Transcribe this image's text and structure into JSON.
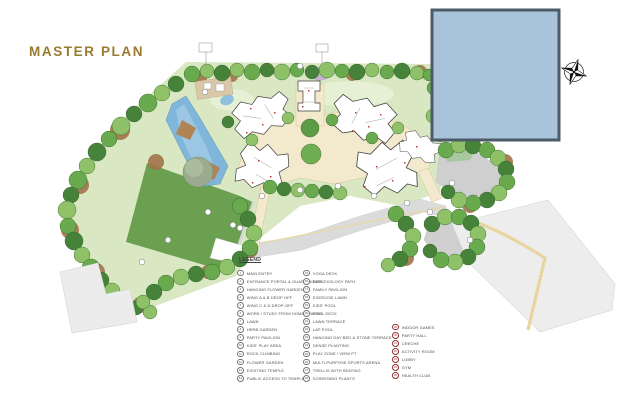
{
  "page": {
    "title": "MASTER PLAN",
    "title_color": "#9a7a2e",
    "background": "#ffffff"
  },
  "map": {
    "inset_box_color": "#a9c3da",
    "inset_box_border": "#4b5c68",
    "compass_icon": "compass-rose",
    "colors": {
      "base_green": "#d9e8c2",
      "lawn_dark": "#6aa04f",
      "tree_dark": "#47823a",
      "tree_mid": "#6aaa4e",
      "tree_light": "#8fc268",
      "mulch_brown": "#a2734b",
      "pool_blue": "#7fb6d9",
      "pool_light": "#a8cfe8",
      "deck_brown": "#b08455",
      "path_cream": "#f3e9cc",
      "road_gray": "#dbdbdb",
      "parcel_gray": "#ededed",
      "building_white": "#ffffff",
      "unit_red": "#c0392b"
    }
  },
  "legend": {
    "title": "LEGEND",
    "accent_color": "#8c3333",
    "columns": [
      {
        "items": [
          {
            "num": "1",
            "label": "MAIN ENTRY"
          },
          {
            "num": "2",
            "label": "ENTRANCE PORTAL & GUARD HOUSE"
          },
          {
            "num": "3",
            "label": "HANGING FLOWER GARDEN"
          },
          {
            "num": "4",
            "label": "WING A & B DROP OFF"
          },
          {
            "num": "5",
            "label": "WING C & D DROP-OFF"
          },
          {
            "num": "6",
            "label": "WORK / STUDY FROM HOME SPACES"
          },
          {
            "num": "7",
            "label": "LAWN"
          },
          {
            "num": "8",
            "label": "HERB GARDEN"
          },
          {
            "num": "9",
            "label": "PARTY PAVILION"
          },
          {
            "num": "10",
            "label": "KIDS' PLAY AREA"
          },
          {
            "num": "11",
            "label": "ROCK CLIMBING"
          },
          {
            "num": "12",
            "label": "FLOWER GARDEN"
          },
          {
            "num": "13",
            "label": "EXISTING TEMPLE"
          },
          {
            "num": "14",
            "label": "PUBLIC ACCESS TO TEMPLE"
          }
        ]
      },
      {
        "items": [
          {
            "num": "15",
            "label": "YOGA DECK"
          },
          {
            "num": "16",
            "label": "REFLEXOLOGY PATH"
          },
          {
            "num": "17",
            "label": "FAMILY PAVILION"
          },
          {
            "num": "18",
            "label": "EXERCISE LAWN"
          },
          {
            "num": "19",
            "label": "KIDS' POOL"
          },
          {
            "num": "20",
            "label": "POOL DECK"
          },
          {
            "num": "21",
            "label": "LAWN TERRACE"
          },
          {
            "num": "22",
            "label": "LAP POOL"
          },
          {
            "num": "23",
            "label": "HANGING DAY BED & STONE TERRACE"
          },
          {
            "num": "24",
            "label": "DENSE PLANTING"
          },
          {
            "num": "25",
            "label": "PLAY ZONE / VIEW PT"
          },
          {
            "num": "26",
            "label": "MULTI-PURPOSE SPORTS ARENA"
          },
          {
            "num": "27",
            "label": "TRELLIS WITH SEATING"
          },
          {
            "num": "28",
            "label": "SCREENING PLANTS"
          }
        ]
      },
      {
        "items": [
          {
            "num": "29",
            "label": "INDOOR GAMES"
          },
          {
            "num": "30",
            "label": "PARTY HALL"
          },
          {
            "num": "31",
            "label": "CRECHE"
          },
          {
            "num": "32",
            "label": "ACTIVITY ROOM"
          },
          {
            "num": "33",
            "label": "LOBBY"
          },
          {
            "num": "34",
            "label": "GYM"
          },
          {
            "num": "35",
            "label": "HEALTH CLUB"
          }
        ]
      }
    ]
  }
}
